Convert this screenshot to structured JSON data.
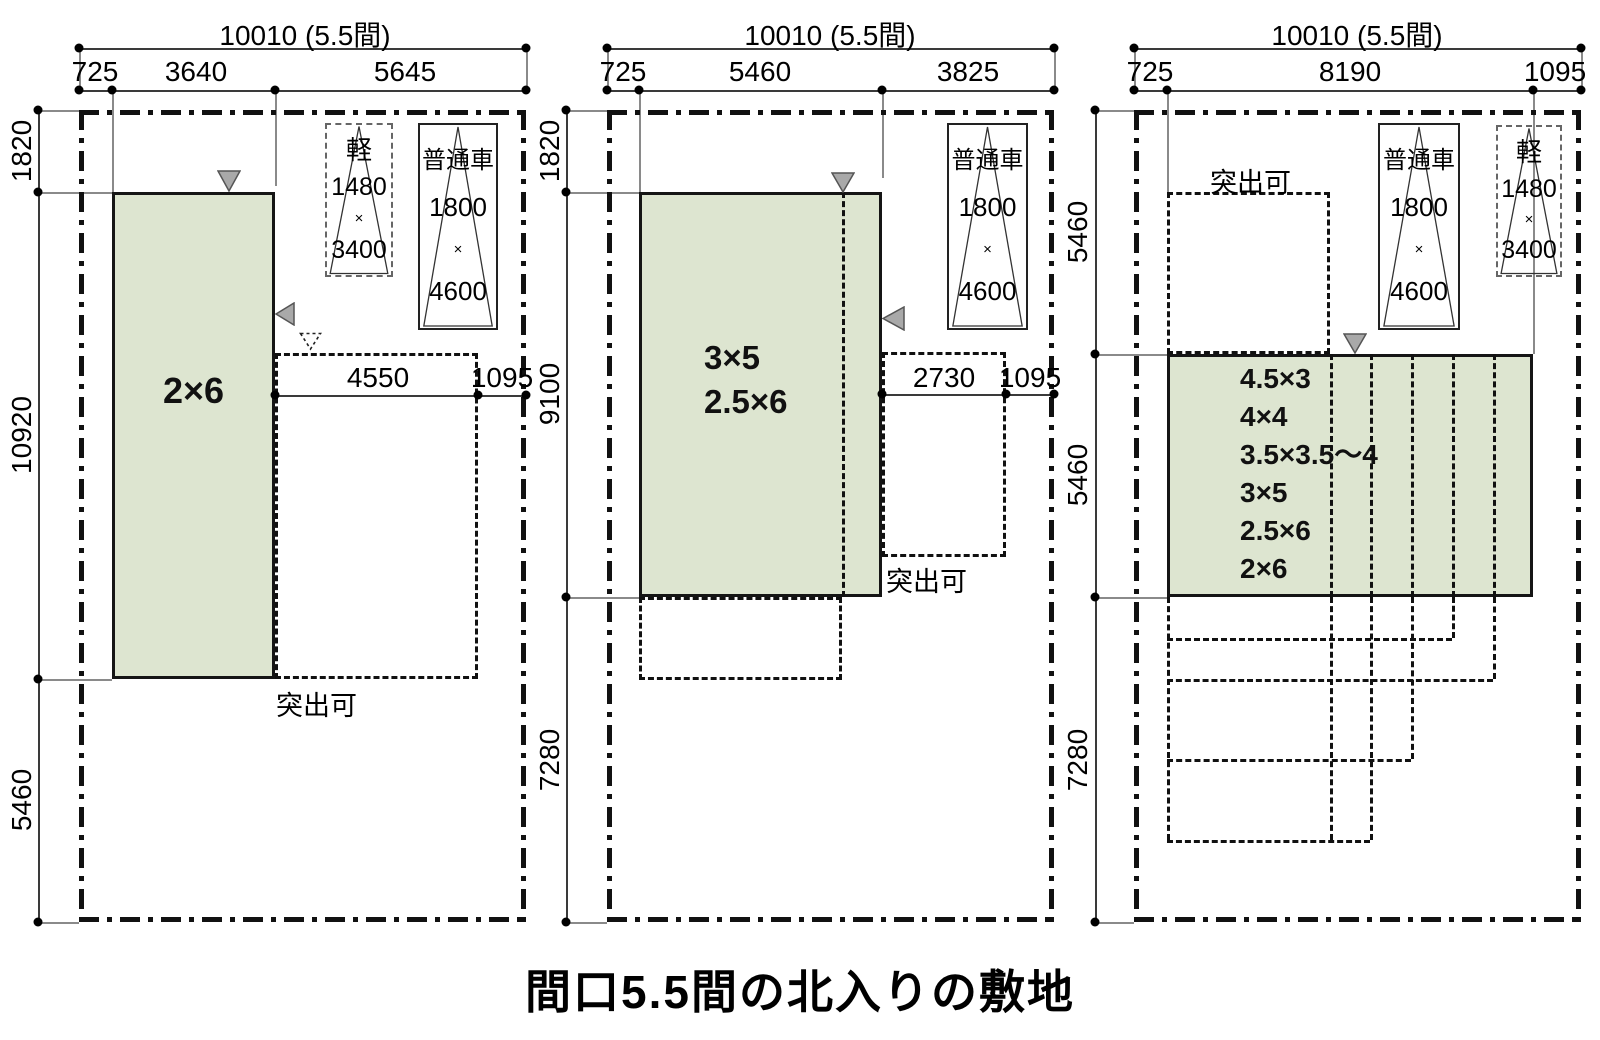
{
  "caption": "間口5.5間の北入りの敷地",
  "colors": {
    "plan_fill": "#dde5d0",
    "marker": "#a9a9a9"
  },
  "panels": [
    {
      "dim_total": "10010 (5.5間)",
      "dim_segments": [
        "725",
        "3640",
        "5645"
      ],
      "dim_left": [
        "1820",
        "10920",
        "5460"
      ],
      "dim_inner": [
        "4550",
        "1095"
      ],
      "plan_labels": [
        "2×6"
      ],
      "protrude": "突出可",
      "car_kei": {
        "name": "軽",
        "width": "1480",
        "times": "×",
        "length": "3400"
      },
      "car_normal": {
        "name": "普通車",
        "width": "1800",
        "times": "×",
        "length": "4600"
      }
    },
    {
      "dim_total": "10010 (5.5間)",
      "dim_segments": [
        "725",
        "5460",
        "3825"
      ],
      "dim_left": [
        "1820",
        "9100",
        "7280"
      ],
      "dim_inner": [
        "2730",
        "1095"
      ],
      "plan_labels": [
        "3×5",
        "2.5×6"
      ],
      "protrude": "突出可",
      "car_normal": {
        "name": "普通車",
        "width": "1800",
        "times": "×",
        "length": "4600"
      }
    },
    {
      "dim_total": "10010 (5.5間)",
      "dim_segments": [
        "725",
        "8190",
        "1095"
      ],
      "dim_left": [
        "5460",
        "5460",
        "7280"
      ],
      "plan_labels": [
        "4.5×3",
        "4×4",
        "3.5×3.5〜4",
        "3×5",
        "2.5×6",
        "2×6"
      ],
      "protrude": "突出可",
      "car_normal": {
        "name": "普通車",
        "width": "1800",
        "times": "×",
        "length": "4600"
      },
      "car_kei": {
        "name": "軽",
        "width": "1480",
        "times": "×",
        "length": "3400"
      }
    }
  ]
}
